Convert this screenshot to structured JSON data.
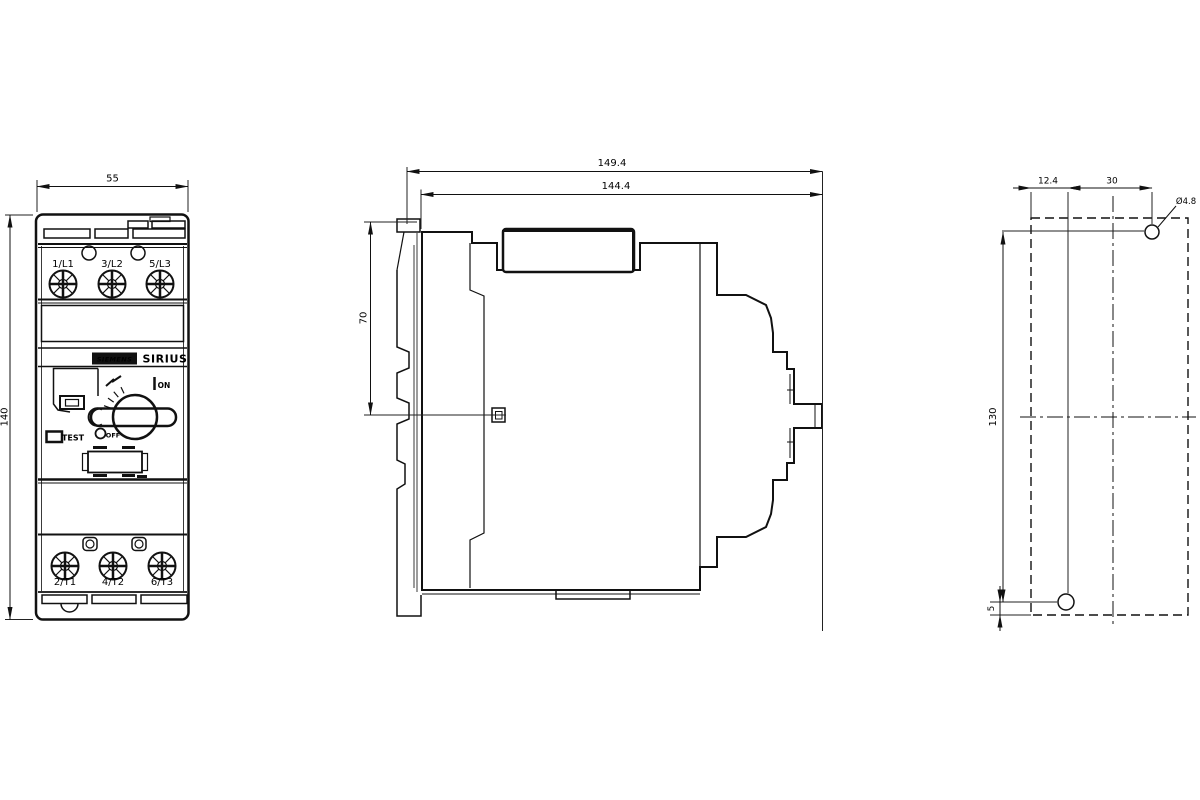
{
  "front_view": {
    "width_dim": "55",
    "height_dim": "140",
    "terminals_top": [
      "1/L1",
      "3/L2",
      "5/L3"
    ],
    "terminals_bottom": [
      "2/T1",
      "4/T2",
      "6/T3"
    ],
    "brand_label": "SIEMENS",
    "series_label": "SIRIUS",
    "on_label": "ON",
    "off_label": "OFF",
    "test_label": "TEST"
  },
  "side_view": {
    "overall_depth_dim": "149.4",
    "mounting_depth_dim": "144.4",
    "top_to_shaft_dim": "70"
  },
  "drill_plan": {
    "edge_to_hole_dim": "12.4",
    "hole_spacing_dim": "30",
    "hole_diameter_label": "Ø4.8",
    "vertical_spacing_dim": "130",
    "bottom_offset_dim": "5"
  },
  "colors": {
    "line": "#111111",
    "background": "#ffffff",
    "nameplate_bg": "#111111",
    "nameplate_fg": "#ffffff"
  }
}
